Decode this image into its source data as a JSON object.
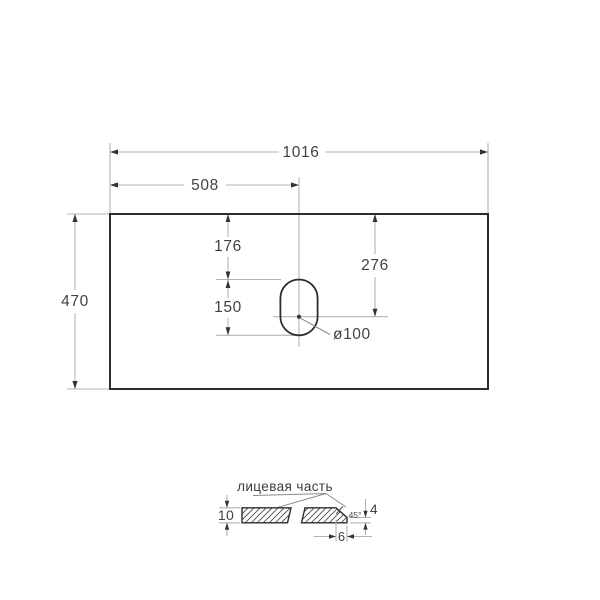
{
  "colors": {
    "outline": "#2d2d2d",
    "dimension_line": "#b4b4b4",
    "text": "#424242",
    "leader": "#8a8a8a"
  },
  "plan_view": {
    "overall_width": "1016",
    "hole_center_from_left": "508",
    "overall_depth": "470",
    "hole_top_offset": "176",
    "hole_arc_center_offset": "276",
    "hole_length": "150",
    "hole_diameter": "ø100"
  },
  "section_view": {
    "face_side_label": "лицевая часть",
    "thickness": "10",
    "edge_land_height": "4",
    "chamfer_angle": "45°",
    "chamfer_width": "6"
  }
}
